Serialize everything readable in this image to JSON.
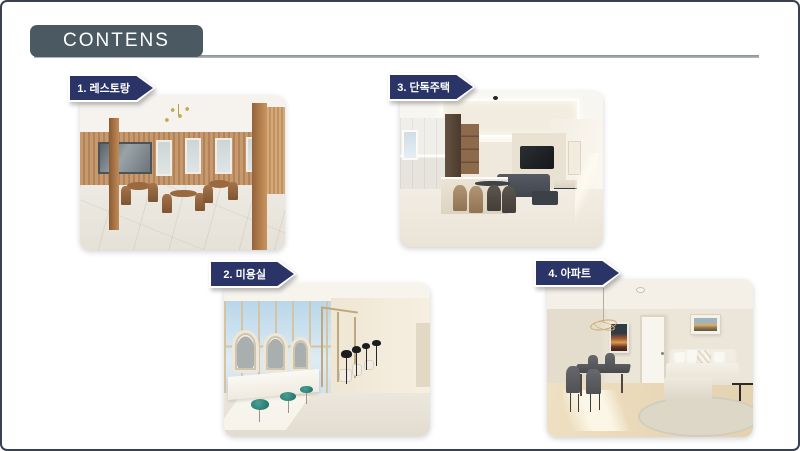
{
  "slide": {
    "title": "CONTENS",
    "sections": [
      {
        "number": "1",
        "label": "1. 레스토랑"
      },
      {
        "number": "2",
        "label": "2. 미용실"
      },
      {
        "number": "3",
        "label": "3. 단독주택"
      },
      {
        "number": "4",
        "label": "4. 아파트"
      }
    ],
    "colors": {
      "banner_navy": "#2b3467",
      "header_slate": "#4b5a62",
      "divider_gray": "#888e94",
      "slide_border": "#3a4050"
    }
  }
}
